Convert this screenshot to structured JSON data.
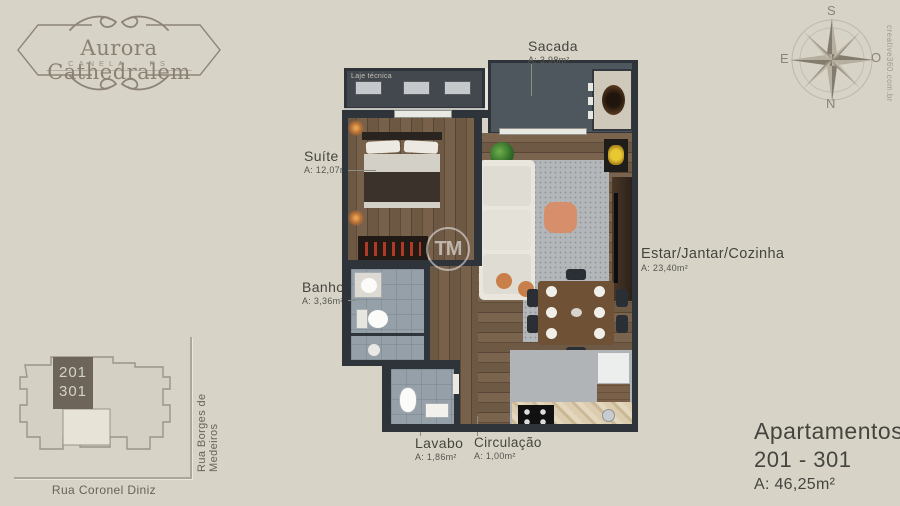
{
  "colors": {
    "background": "#d7d3c7",
    "brand_taupe": "#8a8173",
    "label_text": "#45453f",
    "wall": "#2f343a"
  },
  "logo": {
    "title": "Aurora Cathedralem",
    "subtitle": "CANELA · RS"
  },
  "compass": {
    "s": "S",
    "e": "E",
    "o": "O",
    "n": "N"
  },
  "credit": "creative360.com.br",
  "watermark": "TM",
  "plan": {
    "laje": {
      "name": "Laje técnica"
    },
    "rooms": {
      "sacada": {
        "name": "Sacada",
        "area": "A: 3,98m²"
      },
      "suite": {
        "name": "Suíte",
        "area": "A: 12,07m²"
      },
      "banho": {
        "name": "Banho",
        "area": "A: 3,36m²"
      },
      "estar": {
        "name": "Estar/Jantar/Cozinha",
        "area": "A: 23,40m²"
      },
      "lavabo": {
        "name": "Lavabo",
        "area": "A: 1,86m²"
      },
      "circulacao": {
        "name": "Circulação",
        "area": "A: 1,00m²"
      }
    }
  },
  "site_map": {
    "unit_top": "201",
    "unit_bottom": "301",
    "street_vertical": "Rua Borges de Medeiros",
    "street_horizontal": "Rua Coronel Diniz"
  },
  "apartments": {
    "title": "Apartamentos",
    "range": "201 - 301",
    "area": "A: 46,25m²"
  }
}
